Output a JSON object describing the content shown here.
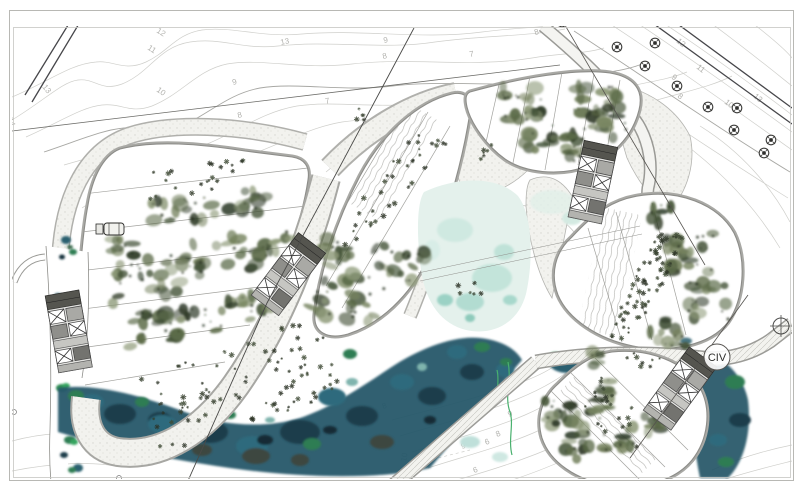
{
  "labels": {
    "section_marker": "CIV"
  },
  "colors": {
    "paper": "#ffffff",
    "contour": "#cfcfcb",
    "contour_dark": "#a8a8a4",
    "ink": "#4a4a48",
    "path_edge": "#a9a9a5",
    "stipple_base": "#f2f2ee",
    "water_deep": "#27586a",
    "water_dark": "#1b3e4c",
    "water_mid": "#2e6b7d",
    "water_green": "#2f7d52",
    "water_bright_green": "#35a45f",
    "pond": "#e4f1ec",
    "canopy_dark": "#2f3b28",
    "canopy_mid": "#5c6b49",
    "canopy_light": "#8e9a79"
  },
  "contour_labels": [
    {
      "text": "14",
      "x": 8,
      "y": 118,
      "rot": 75
    },
    {
      "text": "13",
      "x": 42,
      "y": 87,
      "rot": 52
    },
    {
      "text": "12",
      "x": 156,
      "y": 32,
      "rot": 32
    },
    {
      "text": "11",
      "x": 147,
      "y": 49,
      "rot": 33
    },
    {
      "text": "10",
      "x": 156,
      "y": 91,
      "rot": 35
    },
    {
      "text": "9",
      "x": 233,
      "y": 85,
      "rot": -15
    },
    {
      "text": "8",
      "x": 238,
      "y": 118,
      "rot": -12
    },
    {
      "text": "13",
      "x": 281,
      "y": 45,
      "rot": -12
    },
    {
      "text": "9",
      "x": 384,
      "y": 43,
      "rot": -12
    },
    {
      "text": "8",
      "x": 383,
      "y": 59,
      "rot": -12
    },
    {
      "text": "7",
      "x": 470,
      "y": 57,
      "rot": -12
    },
    {
      "text": "7",
      "x": 326,
      "y": 104,
      "rot": -15
    },
    {
      "text": "8",
      "x": 535,
      "y": 35,
      "rot": -15
    },
    {
      "text": "9",
      "x": 98,
      "y": 164,
      "rot": 35
    },
    {
      "text": "8",
      "x": 103,
      "y": 193,
      "rot": 35
    },
    {
      "text": "6",
      "x": 362,
      "y": 137,
      "rot": -28
    },
    {
      "text": "5",
      "x": 517,
      "y": 212,
      "rot": -5
    },
    {
      "text": "12",
      "x": 676,
      "y": 42,
      "rot": 38
    },
    {
      "text": "11",
      "x": 696,
      "y": 68,
      "rot": 38
    },
    {
      "text": "13",
      "x": 753,
      "y": 97,
      "rot": 40
    },
    {
      "text": "10",
      "x": 724,
      "y": 103,
      "rot": 38
    },
    {
      "text": "9",
      "x": 671,
      "y": 78,
      "rot": 38
    },
    {
      "text": "8",
      "x": 677,
      "y": 97,
      "rot": 38
    },
    {
      "text": "7",
      "x": 626,
      "y": 88,
      "rot": 38
    },
    {
      "text": "6",
      "x": 648,
      "y": 120,
      "rot": 38
    },
    {
      "text": "8",
      "x": 383,
      "y": 409,
      "rot": -18
    },
    {
      "text": "9",
      "x": 509,
      "y": 417,
      "rot": -22
    },
    {
      "text": "8",
      "x": 497,
      "y": 437,
      "rot": -22
    },
    {
      "text": "6",
      "x": 486,
      "y": 445,
      "rot": -22
    },
    {
      "text": "9",
      "x": 462,
      "y": 449,
      "rot": -18
    },
    {
      "text": "10",
      "x": 406,
      "y": 462,
      "rot": -80
    },
    {
      "text": "6",
      "x": 474,
      "y": 473,
      "rot": -18
    },
    {
      "text": "7",
      "x": 565,
      "y": 431,
      "rot": -22
    }
  ],
  "tree_symbols": [
    {
      "x": 562,
      "y": 22
    },
    {
      "x": 617,
      "y": 47
    },
    {
      "x": 655,
      "y": 43
    },
    {
      "x": 645,
      "y": 66
    },
    {
      "x": 677,
      "y": 86
    },
    {
      "x": 708,
      "y": 107
    },
    {
      "x": 737,
      "y": 108
    },
    {
      "x": 734,
      "y": 130
    },
    {
      "x": 771,
      "y": 140
    },
    {
      "x": 764,
      "y": 153
    }
  ],
  "survey_marker": {
    "x": 781,
    "y": 326
  }
}
